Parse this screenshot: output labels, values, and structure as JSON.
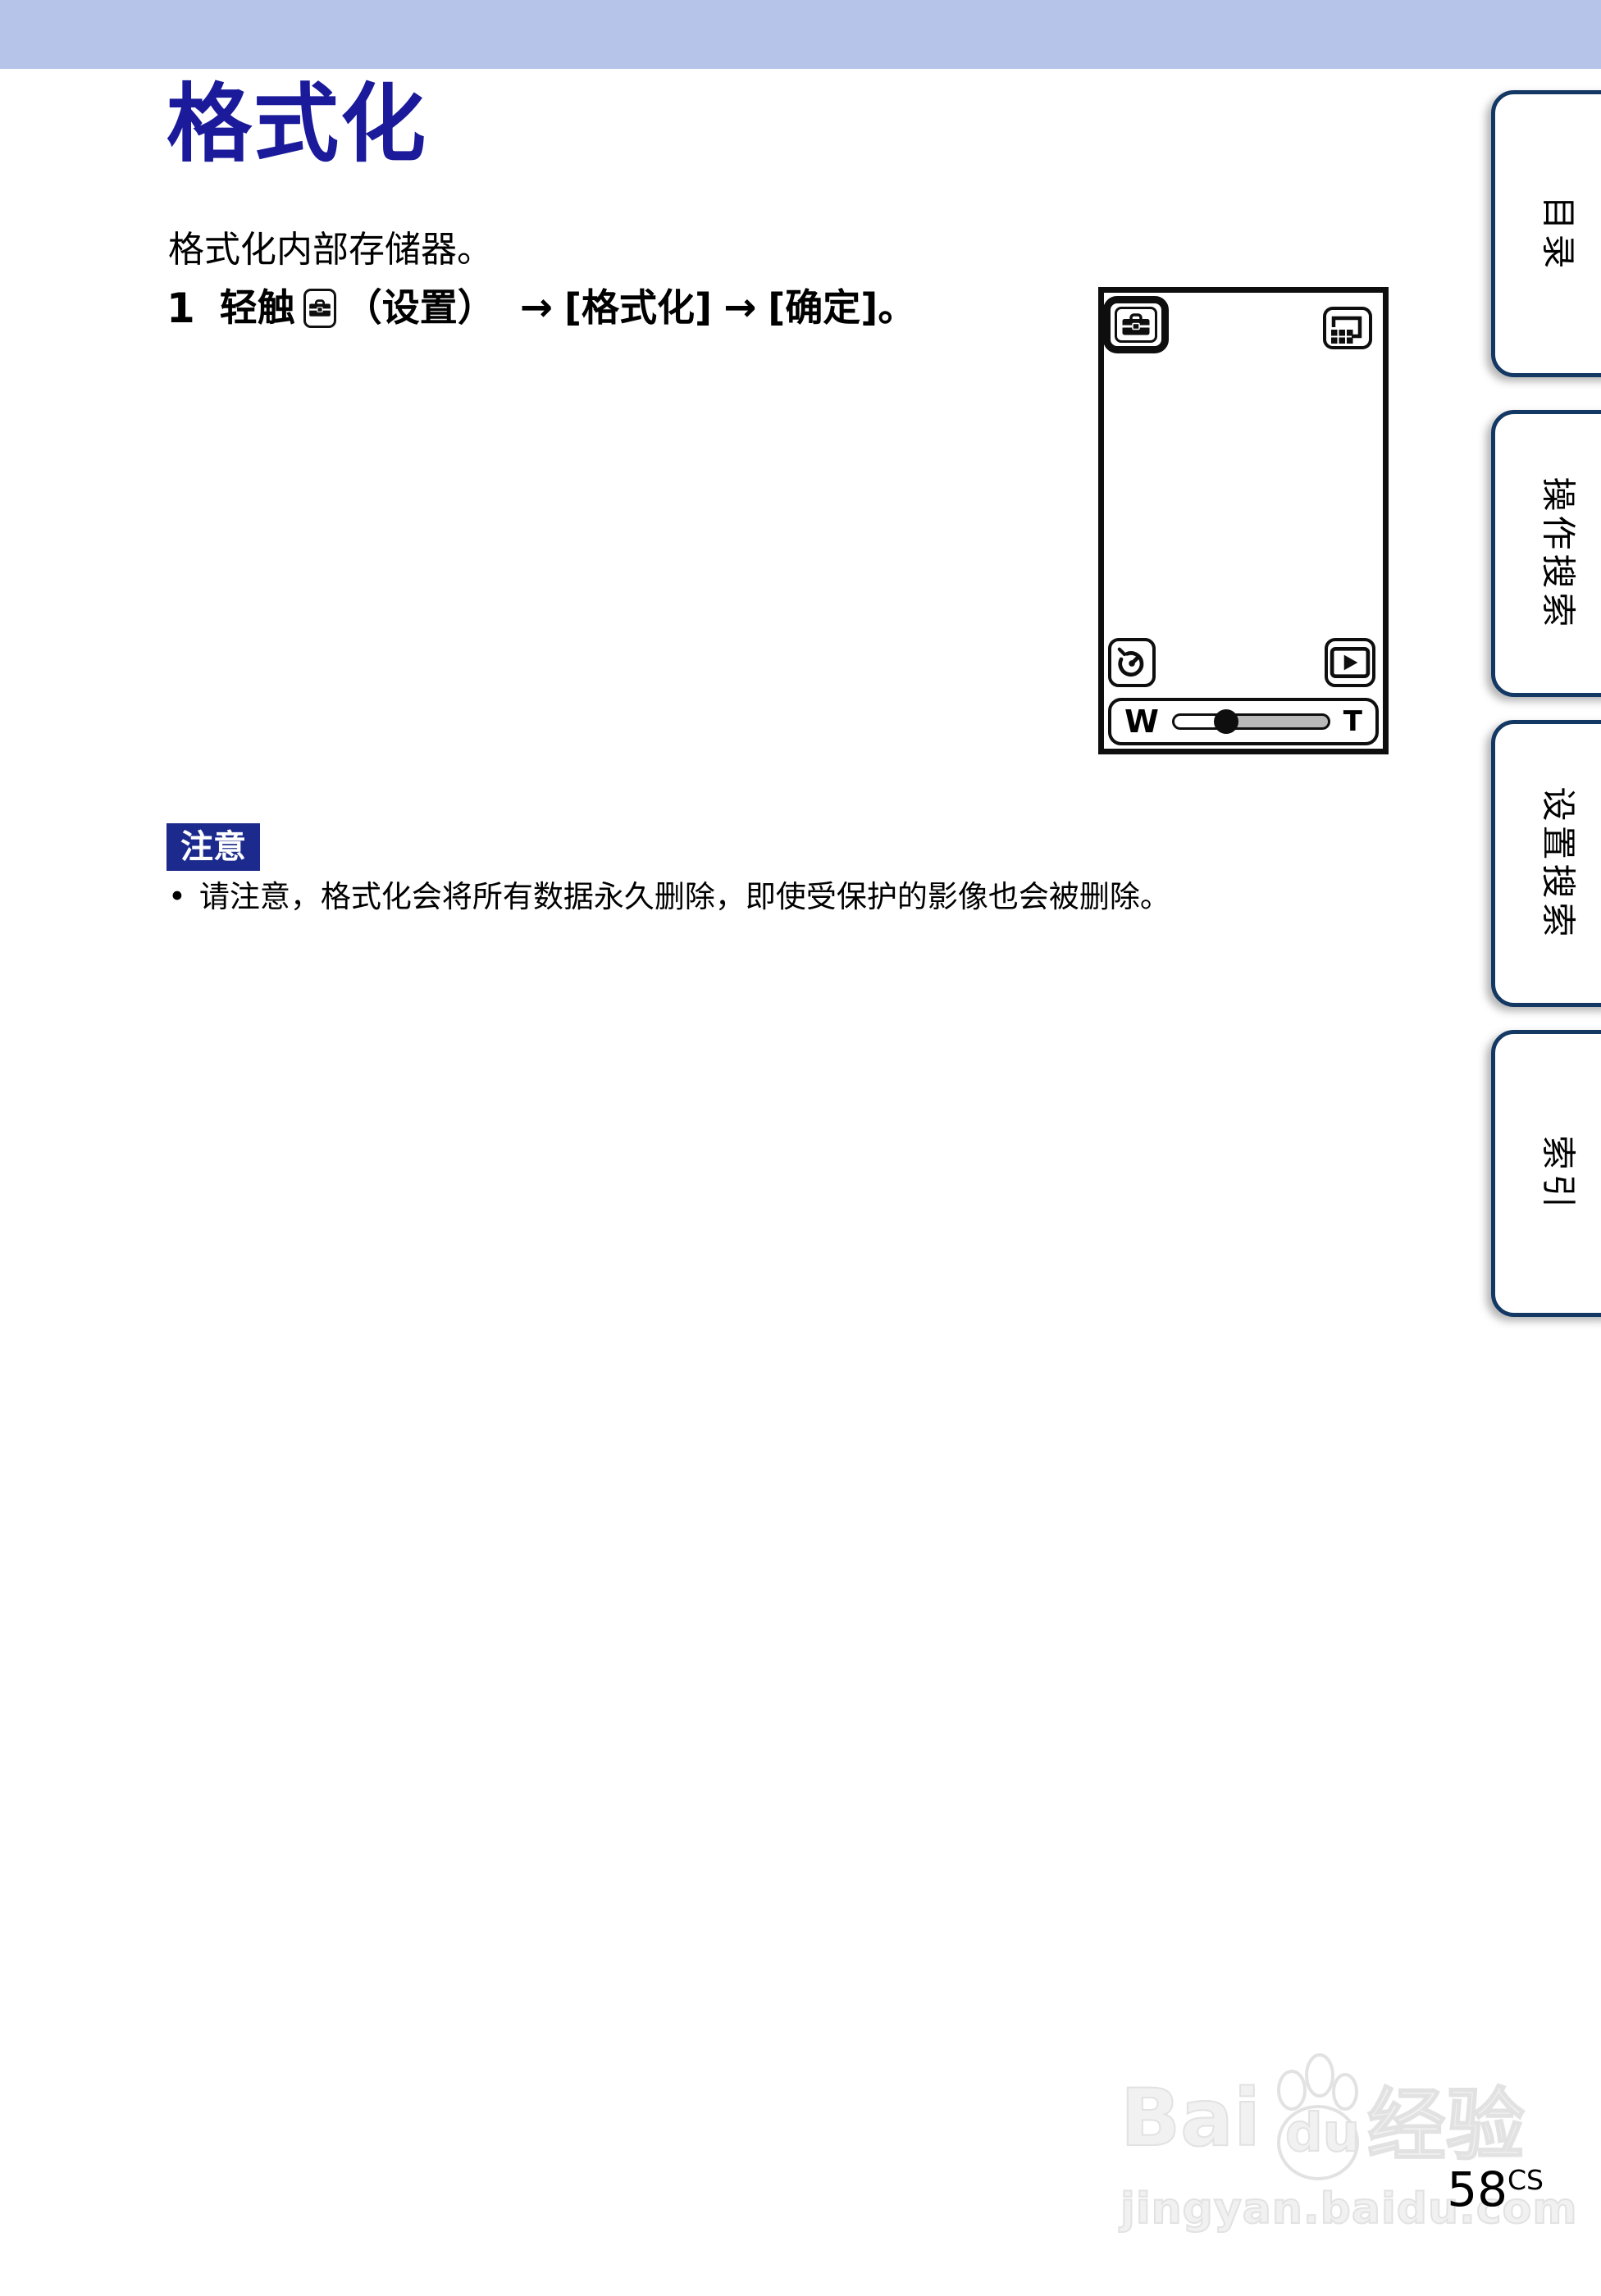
{
  "page": {
    "title": "格式化",
    "intro": "格式化内部存储器。",
    "page_number": "58",
    "page_number_suffix": "CS"
  },
  "step1": {
    "number": "1",
    "touch_label": "轻触",
    "settings_icon": "toolbox-settings-icon",
    "settings_label": "（设置）",
    "arrow1": "→",
    "format_label": "[格式化]",
    "arrow2": "→",
    "ok_label": "[确定]。"
  },
  "note": {
    "badge": "注意",
    "bullet": "•",
    "text": "请注意，格式化会将所有数据永久删除，即使受保护的影像也会被删除。"
  },
  "camera_screen": {
    "zoom_wide": "W",
    "zoom_tele": "T",
    "zoom_knob_pct": 34
  },
  "sidebar": {
    "tabs": [
      {
        "id": "contents",
        "label": "目录"
      },
      {
        "id": "operation-search",
        "label": "操作搜索"
      },
      {
        "id": "settings-search",
        "label": "设置搜索"
      },
      {
        "id": "index",
        "label": "索引"
      }
    ]
  },
  "watermark": {
    "part1": "Bai",
    "part2": "du",
    "part3": "经验",
    "url": "jingyan.baidu.com"
  },
  "colors": {
    "banner": "#b6c4e9",
    "title": "#1a1a9a",
    "note_badge_bg": "#1b2a8c",
    "tab_border": "#133863"
  }
}
